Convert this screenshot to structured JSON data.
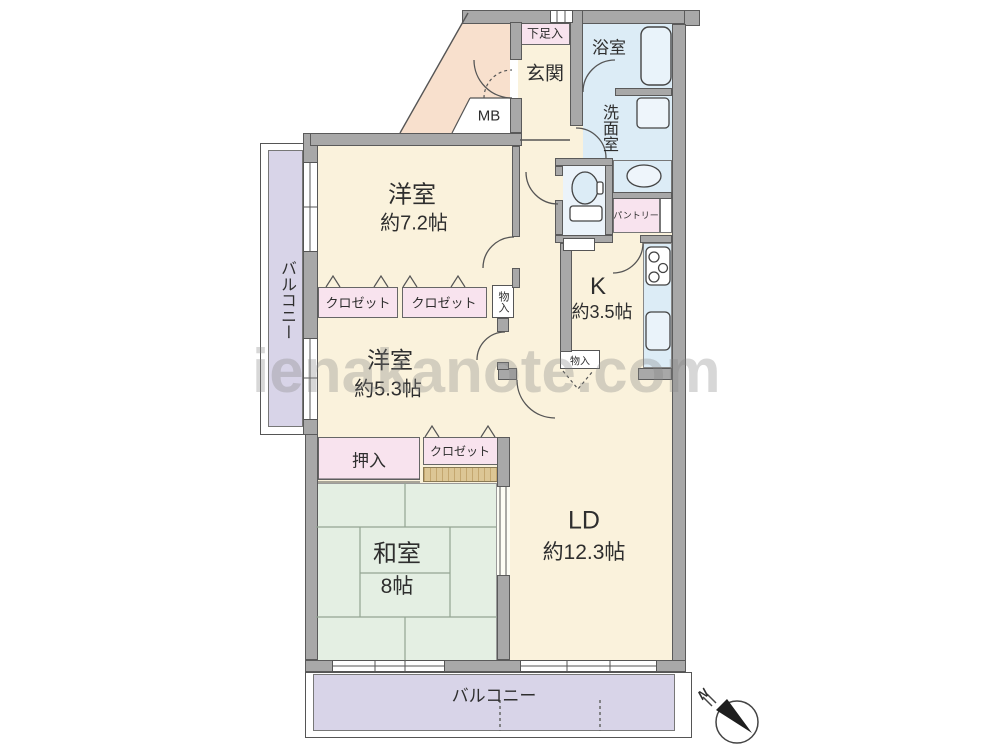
{
  "colors": {
    "cream": "#faf2dc",
    "peach": "#f8e0cd",
    "pink": "#f8e3ee",
    "blue": "#dcecf6",
    "green": "#e4efe3",
    "lavender": "#d8d4e8",
    "tan": "#dcc695",
    "wall": "#a8a8a8"
  },
  "watermark": {
    "text": "ienakanote.com"
  },
  "compass": {
    "label": "N"
  },
  "rooms": {
    "western1": {
      "name": "洋室",
      "size": "約7.2帖"
    },
    "western2": {
      "name": "洋室",
      "size": "約5.3帖"
    },
    "japanese": {
      "name": "和室",
      "size": "8帖"
    },
    "living": {
      "name": "LD",
      "size": "約12.3帖"
    },
    "kitchen": {
      "name": "K",
      "size": "約3.5帖"
    },
    "entrance": {
      "name": "玄関"
    },
    "bath": {
      "name": "浴室"
    },
    "washroom": {
      "name": "洗面室"
    },
    "pantry": {
      "name": "パントリー"
    }
  },
  "storages": {
    "shoe_cabinet": "下足入",
    "closet_a": "クロゼット",
    "closet_b": "クロゼット",
    "closet_c": "クロゼット",
    "oshiire": "押入",
    "storage_hall": "物入",
    "storage_kitchen": "物入",
    "meter_box": "MB"
  },
  "balconies": {
    "left": "バルコニー",
    "bottom": "バルコニー"
  }
}
